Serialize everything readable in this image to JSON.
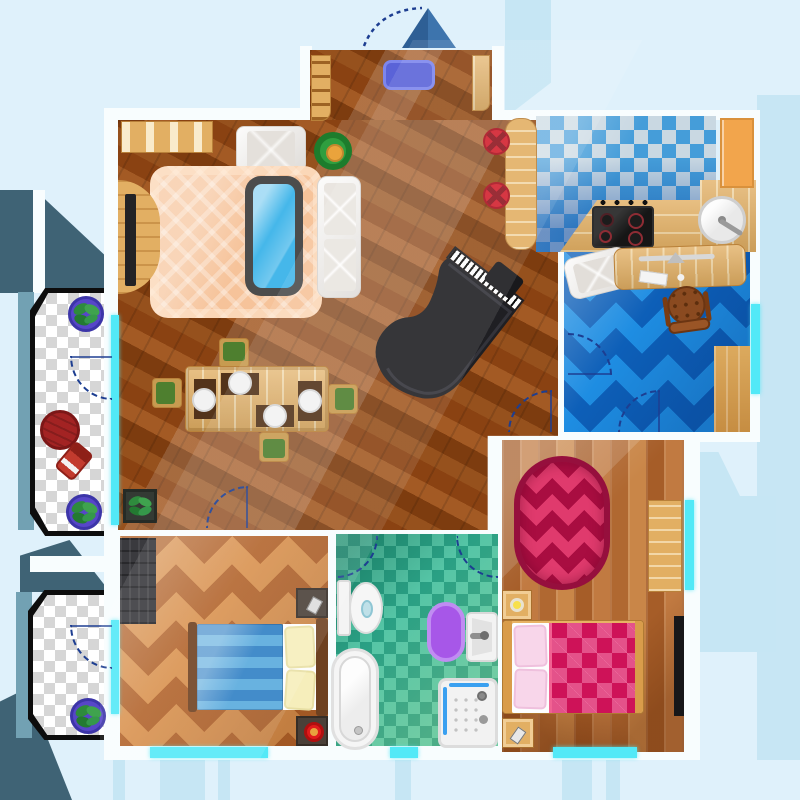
{
  "scene": {
    "type": "apartment-floor-plan-top-view",
    "rooms": [
      {
        "name": "entrance-hall",
        "floor": "dark-wood-parquet",
        "furniture": [
          "doormat",
          "coat-rack",
          "shoe-shelf",
          "open-entrance-door"
        ]
      },
      {
        "name": "living-room",
        "floor": "dark-wood-parquet",
        "furniture": [
          "peach-plaid-rug",
          "glass-coffee-table",
          "white-sofa",
          "white-armchair",
          "potted-plant-ring",
          "tv-stand-with-tv",
          "wall-shelf",
          "dining-table",
          "dining-chairs-x4",
          "place-settings-x4",
          "grand-piano",
          "piano-bench",
          "square-planter"
        ]
      },
      {
        "name": "kitchen",
        "floor": "blue-white-checker-tile",
        "furniture": [
          "bar-counter",
          "bar-stools-x2",
          "l-shaped-counter",
          "stove-4-burners",
          "round-sink",
          "tall-orange-cabinet"
        ]
      },
      {
        "name": "office",
        "floor": "blue-chevron-carpet",
        "furniture": [
          "white-armchair",
          "desk-with-monitor-keyboard",
          "office-chair",
          "wood-floor-patch",
          "window"
        ]
      },
      {
        "name": "master-bedroom",
        "floor": "vertical-wood-planks",
        "furniture": [
          "crimson-oval-rug",
          "dresser",
          "nightstand-with-lamp",
          "double-bed-pink-diamond-blanket",
          "pink-pillows-x2",
          "nightstand-with-phone",
          "black-wardrobe",
          "window"
        ]
      },
      {
        "name": "bathroom",
        "floor": "teal-checker-tile",
        "furniture": [
          "toilet",
          "purple-oval-rug",
          "wall-sink",
          "bathtub",
          "shower-cabin"
        ]
      },
      {
        "name": "second-bedroom",
        "floor": "orange-chevron-parquet",
        "furniture": [
          "dark-wardrobe",
          "double-bed-blue-striped-blanket",
          "cream-pillows-x2",
          "nightstand-with-phone",
          "nightstand-with-red-lamp",
          "window"
        ]
      },
      {
        "name": "balcony-upper",
        "floor": "transparent-checkerboard",
        "furniture": [
          "potted-plant-x2",
          "round-red-table",
          "red-chair"
        ]
      },
      {
        "name": "balcony-lower",
        "floor": "transparent-checkerboard",
        "furniture": [
          "potted-plant"
        ]
      }
    ],
    "door_arcs": 9,
    "window_segments": 7
  },
  "palette": {
    "bg": "#dff1fb",
    "band": "#c6e6f4",
    "bandDeep": "#bfe2f2",
    "slate": "#3f6375",
    "slateDark": "#27454f",
    "steel": "#72a1b3",
    "wallWhite": "#f8fdfe",
    "windowCyan": "#52e9f7",
    "woodFloor": "#8a4212",
    "plankBase": "#b8703a",
    "tableWood": "#e2af63",
    "woodLightEdge": "#b9813a",
    "counterOrange": "#f2a54c",
    "kitchenBlue": "#459dd9",
    "kitchenPale": "#c9d8e2",
    "kitchenDeep": "#0f57a8",
    "officeBlueLight": "#1e8de2",
    "officeBlueDark": "#0d5fb8",
    "bathTealLight": "#55c5a6",
    "bathTealDark": "#2aa084",
    "bed2OrangeLight": "#d9924f",
    "bed2OrangeDark": "#b2642c",
    "crimson": "#c51050",
    "crimsonZig": "#e03a6d",
    "crimsonZigDark": "#a90d41",
    "blanketBlue1": "#2e7fc4",
    "blanketBlue2": "#57a9dd",
    "pillowCream": "#f6eebb",
    "pillowPink": "#f8d6ea",
    "rugPeach": "#f6c39a",
    "glassBlue": "#45b7ea",
    "whiteFurniture": "#f1efec",
    "greenChair": "#4e7f2f",
    "greenPlant": "#2e8b3d",
    "stoolRed": "#d2202e",
    "rugPurple": "#a757e8",
    "doormatBlue": "#5a63d8",
    "arcBlue": "#1d3e91",
    "piano": "#1f1f23"
  }
}
